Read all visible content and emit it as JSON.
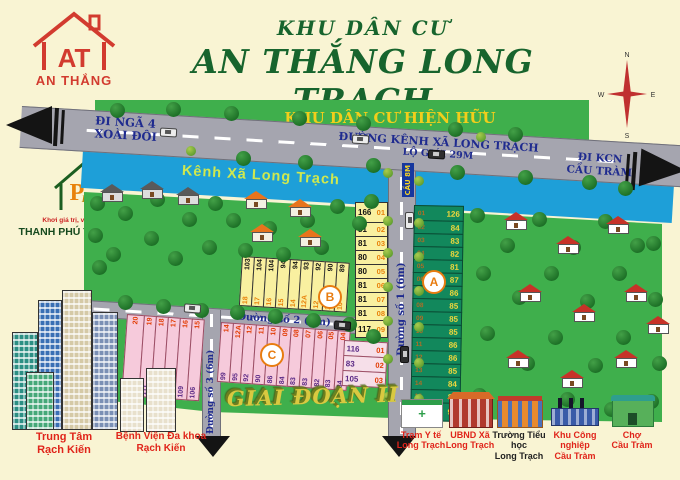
{
  "branding": {
    "at_logo": {
      "initials": "AT",
      "name": "AN THẮNG"
    },
    "land_logo": {
      "letter": "P",
      "word": "LAND",
      "tagline": "Khơi giá trị, vững niềm tin",
      "name": "THANH PHÚ THỊNH LAND"
    }
  },
  "title": {
    "line1": "KHU DÂN CƯ",
    "line2": "AN THẮNG LONG TRẠCH"
  },
  "compass": {
    "n": "N",
    "e": "E",
    "s": "S",
    "w": "W"
  },
  "map": {
    "existing_area": "KHU DÂN CƯ HIỆN HỮU",
    "main_road_name": "ĐƯỜNG KÊNH XÃ LONG TRẠCH",
    "main_road_note": "LỘ GIỚI 29M",
    "dir_left_line1": "ĐI NGÃ 4",
    "dir_left_line2": "XOÀI ĐÔI",
    "dir_right_line1": "ĐI KCN",
    "dir_right_line2": "CẦU TRÀM",
    "canal_name": "Kênh Xã Long Trạch",
    "bridge_sign": "CẦU 8M",
    "street1": "Đường số 1 (6m)",
    "street2": "Đường số 2 (6m)",
    "street3": "Đường số 3 (6m)",
    "phase_label": "GIAI ĐOẠN II",
    "marker_a": "A",
    "marker_b": "B",
    "marker_c": "C"
  },
  "plots": {
    "b_column": [
      {
        "area": "166",
        "id": "01"
      },
      {
        "area": "81",
        "id": "02"
      },
      {
        "area": "81",
        "id": "03"
      },
      {
        "area": "80",
        "id": "04"
      },
      {
        "area": "80",
        "id": "05"
      },
      {
        "area": "81",
        "id": "06"
      },
      {
        "area": "81",
        "id": "07"
      },
      {
        "area": "81",
        "id": "08"
      },
      {
        "area": "117",
        "id": "09"
      }
    ],
    "b_row": [
      {
        "id": "18",
        "area": "103"
      },
      {
        "id": "17",
        "area": "104"
      },
      {
        "id": "16",
        "area": "104"
      },
      {
        "id": "15",
        "area": "94"
      },
      {
        "id": "14",
        "area": "94"
      },
      {
        "id": "12A",
        "area": "93"
      },
      {
        "id": "12",
        "area": "92"
      },
      {
        "id": "11",
        "area": "90"
      },
      {
        "id": "10",
        "area": "89"
      }
    ],
    "a_column": [
      {
        "id": "01",
        "area": "126"
      },
      {
        "id": "02",
        "area": "84"
      },
      {
        "id": "03",
        "area": "83"
      },
      {
        "id": "04",
        "area": "82"
      },
      {
        "id": "05",
        "area": "81"
      },
      {
        "id": "06",
        "area": "87"
      },
      {
        "id": "07",
        "area": "86"
      },
      {
        "id": "08",
        "area": "85"
      },
      {
        "id": "09",
        "area": "85"
      },
      {
        "id": "10",
        "area": "85"
      },
      {
        "id": "11",
        "area": "86"
      },
      {
        "id": "12",
        "area": "86"
      },
      {
        "id": "13",
        "area": "85"
      },
      {
        "id": "14",
        "area": "84"
      },
      {
        "id": "15",
        "area": "83"
      },
      {
        "id": "16",
        "area": "96"
      }
    ],
    "c_left": [
      {
        "id": "20",
        "area": "232"
      },
      {
        "id": "19",
        "area": "111"
      },
      {
        "id": "18",
        "area": "110"
      },
      {
        "id": "17",
        "area": "109"
      },
      {
        "id": "16",
        "area": "109"
      },
      {
        "id": "15",
        "area": "106"
      }
    ],
    "c_mid": [
      {
        "id": "14",
        "area": "99"
      },
      {
        "id": "12A",
        "area": "95"
      },
      {
        "id": "12",
        "area": "92"
      },
      {
        "id": "11",
        "area": "90"
      },
      {
        "id": "10",
        "area": "86"
      },
      {
        "id": "09",
        "area": "84"
      },
      {
        "id": "08",
        "area": "83"
      },
      {
        "id": "07",
        "area": "83"
      },
      {
        "id": "06",
        "area": "82"
      },
      {
        "id": "05",
        "area": "83"
      },
      {
        "id": "04",
        "area": "84"
      }
    ],
    "c_right": [
      {
        "area": "116",
        "id": "01"
      },
      {
        "area": "83",
        "id": "02"
      },
      {
        "area": "105",
        "id": "03"
      }
    ]
  },
  "landmarks": {
    "city": {
      "line1": "Trung Tâm",
      "line2": "Rạch Kiến"
    },
    "hospital": {
      "line1": "Bệnh Viện Đa khoa",
      "line2": "Rạch Kiến"
    },
    "clinic": {
      "line1": "Trạm Y tế",
      "line2": "Long Trạch"
    },
    "ubnd": {
      "line1": "UBND Xã",
      "line2": "Long Trạch"
    },
    "school": {
      "line1": "Trường Tiểu học",
      "line2": "Long Trạch"
    },
    "industrial": {
      "line1": "Khu Công nghiệp",
      "line2": "Cầu Tràm"
    },
    "market": {
      "line1": "Chợ",
      "line2": "Cầu Tràm"
    }
  },
  "colors": {
    "title_green": "#17642D",
    "map_green": "#3FAF4C",
    "canal_blue": "#1E9FD8",
    "road_gray": "#A5A5AF",
    "plot_yellow": "#F9F0A0",
    "plot_pink": "#F6CADB",
    "plot_teal": "#12885C",
    "label_navy": "#1F2B8F",
    "highlight_yellow": "#F2CE1B",
    "marker_orange": "#E87C10",
    "logo_red": "#D23B2F"
  }
}
